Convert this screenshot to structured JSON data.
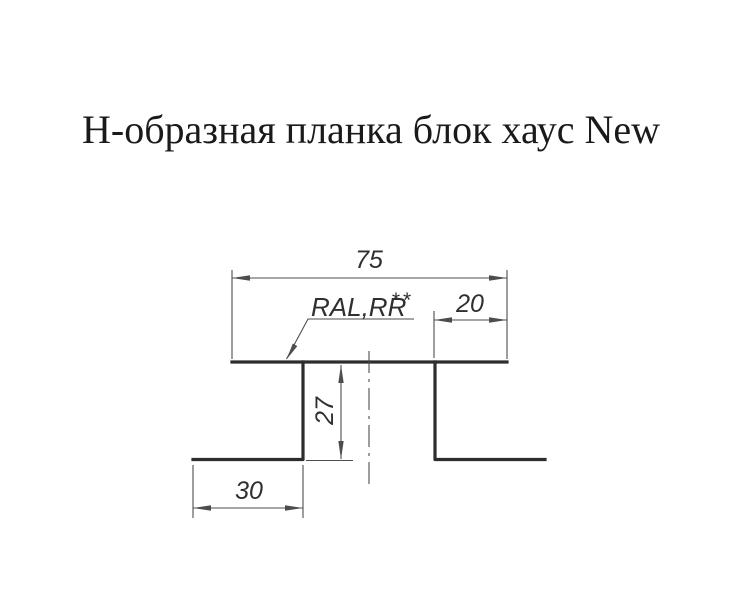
{
  "title": "Н-образная планка блок хаус New",
  "drawing": {
    "dimensions": {
      "top_width": "75",
      "right_flange_width": "20",
      "web_height": "27",
      "bottom_flange_width": "30"
    },
    "coating_label": "RAL,RR",
    "coating_stars": "**",
    "colors": {
      "profile_line": "#2d2d2d",
      "dimension_line": "#4d4d4d",
      "text": "#2f2f2f",
      "title": "#1a1a1a",
      "background": "#ffffff"
    }
  }
}
